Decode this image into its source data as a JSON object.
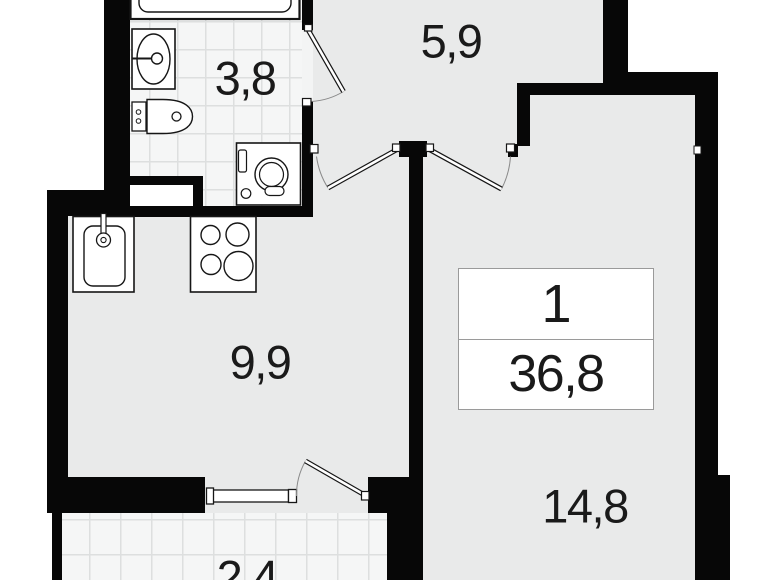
{
  "plan": {
    "rooms": {
      "bathroom": {
        "name": "bathroom",
        "area": "3,8"
      },
      "hallway": {
        "name": "hallway",
        "area": "5,9"
      },
      "kitchen": {
        "name": "kitchen",
        "area": "9,9"
      },
      "living_room": {
        "name": "living-room",
        "area": "14,8"
      },
      "balcony": {
        "name": "balcony",
        "area": "2,4"
      }
    },
    "summary": {
      "rooms_count": "1",
      "total_area": "36,8"
    },
    "fixtures": [
      "bathtub",
      "washbasin",
      "toilet",
      "washing-machine",
      "kitchen-sink",
      "stove",
      "window",
      "doors"
    ],
    "colors": {
      "wall": "#070707",
      "floor": "#e9eaea",
      "tile": "#f5f6f6",
      "tile_line": "#dddfdf",
      "exterior": "#ffffff",
      "text": "#1a1a1a"
    }
  }
}
